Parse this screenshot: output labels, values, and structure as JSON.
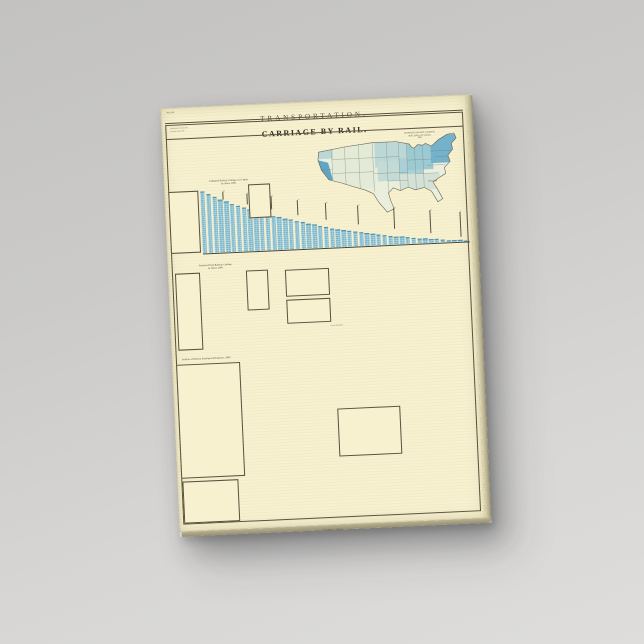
{
  "canvas": {
    "plate_no": "Plate 142.",
    "series_title": "TRANSPORTATION.",
    "title": "CARRIAGE BY RAIL.",
    "note_lines": [
      "Based upon the returns of the",
      "Eleventh Census, 1890."
    ],
    "imprint": "JULIUS BIEN & CO. LITH. N.Y."
  },
  "map": {
    "title_lines": [
      "ESTIMATED RAILWAY CARRIAGE,",
      "PER CAPITA, BY STATES,",
      "1890."
    ],
    "legend_title": "DOLLARS.",
    "legend": [
      {
        "label": "Under 5",
        "color": "#e9efdc"
      },
      {
        "label": "5 to 10",
        "color": "#d7e5d8"
      },
      {
        "label": "10 to 15",
        "color": "#bcd8d6"
      },
      {
        "label": "15 to 20",
        "color": "#9ccad3"
      },
      {
        "label": "20 to 30",
        "color": "#7cb8cd"
      },
      {
        "label": "30 to 40",
        "color": "#5ba4c4"
      },
      {
        "label": "40 to 50",
        "color": "#3f8fb6"
      },
      {
        "label": "50 and over",
        "color": "#2c7aa6"
      }
    ]
  },
  "chart_data": [
    {
      "id": "per_capita",
      "type": "bar",
      "orientation": "vertical",
      "title_lines": [
        "Estimated Railway Carriage, per Capita,",
        "by States, 1890."
      ],
      "table_head": [
        "STATES.",
        "DOLLS."
      ],
      "unit": "dollars per capita",
      "categories": [
        "Nevada",
        "Montana",
        "Wyoming",
        "Colorado",
        "Arizona",
        "New Hampshire",
        "Massachusetts",
        "Idaho",
        "Connecticut",
        "California",
        "New York",
        "Washington",
        "Oregon",
        "Illinois",
        "New Jersey",
        "Pennsylvania",
        "Utah",
        "Minnesota",
        "Rhode Island",
        "Maryland",
        "Ohio",
        "Vermont",
        "Maine",
        "Iowa",
        "Wisconsin",
        "Michigan",
        "Missouri",
        "Nebraska",
        "Kansas",
        "Delaware",
        "Indiana",
        "New Mexico",
        "Florida",
        "Texas",
        "Kentucky",
        "Virginia",
        "Georgia",
        "Louisiana",
        "Tennessee",
        "West Virginia",
        "South Carolina",
        "Alabama",
        "North Carolina",
        "Arkansas",
        "Mississippi",
        "Dakota"
      ],
      "values": [
        62,
        59,
        56,
        53.5,
        51,
        48.5,
        46,
        44,
        42,
        40,
        38,
        36,
        34.5,
        33,
        31.5,
        30,
        28.5,
        27,
        25.5,
        24,
        22.5,
        21,
        19.5,
        18,
        17,
        16,
        15,
        14,
        13,
        12,
        11,
        10,
        9.2,
        8.4,
        7.6,
        6.8,
        6.1,
        5.4,
        4.8,
        4.2,
        3.6,
        3,
        2.5,
        2,
        1.6,
        1.2
      ],
      "pins": [
        {
          "x": 22,
          "top": 0,
          "h": 8,
          "t": "50"
        },
        {
          "x": 46,
          "top": 3,
          "h": 11,
          "t": "45"
        },
        {
          "x": 70,
          "top": 7,
          "h": 13,
          "t": "40"
        },
        {
          "x": 96,
          "top": 12,
          "h": 15,
          "t": "34"
        },
        {
          "x": 124,
          "top": 16,
          "h": 17,
          "t": "28"
        },
        {
          "x": 156,
          "top": 20,
          "h": 19,
          "t": "22"
        },
        {
          "x": 192,
          "top": 24,
          "h": 21,
          "t": "16"
        },
        {
          "x": 228,
          "top": 28,
          "h": 23,
          "t": "10"
        },
        {
          "x": 258,
          "top": 31,
          "h": 25,
          "t": "5"
        }
      ]
    },
    {
      "id": "total_carriage",
      "type": "bar",
      "orientation": "horizontal",
      "title_lines": [
        "Estimated Total Railway Carriage,",
        "by States, 1890."
      ],
      "table_head": [
        "STATES.",
        "MILLIONS."
      ],
      "unit": "millions of dollars",
      "categories": [
        "New York",
        "Pennsylvania",
        "Illinois",
        "Ohio",
        "Massachusetts",
        "Missouri",
        "Iowa",
        "Indiana",
        "Michigan",
        "Kansas",
        "Texas",
        "Wisconsin",
        "Minnesota",
        "California",
        "New Jersey",
        "Kentucky",
        "Georgia",
        "Tennessee",
        "Virginia",
        "Nebraska",
        "Maryland",
        "Connecticut",
        "Alabama",
        "Colorado",
        "Maine",
        "North Carolina",
        "South Carolina",
        "Louisiana",
        "Mississippi",
        "Arkansas",
        "New Hampshire",
        "West Virginia",
        "Vermont",
        "Montana",
        "Rhode Island",
        "Florida",
        "Oregon",
        "Washington",
        "Delaware",
        "Utah",
        "Nevada",
        "Wyoming",
        "Idaho",
        "New Mexico",
        "Arizona"
      ],
      "values": [
        268,
        240,
        213,
        190,
        170,
        152,
        136,
        122,
        109,
        98,
        88,
        79,
        71,
        64,
        57,
        51,
        46,
        41,
        37,
        33,
        30,
        27,
        24,
        21.5,
        19,
        17,
        15,
        13.5,
        12,
        10.7,
        9.5,
        8.4,
        7.4,
        6.5,
        5.7,
        5,
        4.4,
        3.8,
        3.3,
        2.8,
        2.4,
        2,
        1.7,
        1.4,
        1.1
      ],
      "ticks": [
        "0",
        "50",
        "100",
        "150",
        "200",
        "250",
        "300",
        "350",
        "400",
        "450",
        "500"
      ],
      "callouts": [
        {
          "x": 270,
          "y": 0,
          "t": "New York"
        },
        {
          "x": 242,
          "y": 2,
          "t": "Pennsylvania"
        },
        {
          "x": 215,
          "y": 3,
          "t": "Illinois"
        },
        {
          "x": 192,
          "y": 5,
          "t": "Ohio"
        },
        {
          "x": 154,
          "y": 8,
          "t": "Missouri"
        },
        {
          "x": 111,
          "y": 13,
          "t": "Michigan"
        },
        {
          "x": 73,
          "y": 21,
          "t": "New Jersey"
        },
        {
          "x": 48,
          "y": 31,
          "t": "Maryland"
        },
        {
          "x": 31,
          "y": 44,
          "t": "Louisiana"
        },
        {
          "x": 20,
          "y": 60,
          "t": "Oregon"
        }
      ]
    },
    {
      "id": "earnings_expenses",
      "type": "bar",
      "orientation": "horizontal",
      "title": "Analysis of Railway Earnings and Expenses, 1890.",
      "table_head": [
        "ITEMS.",
        "AMOUNT."
      ],
      "unit": "millions of dollars",
      "categories": [
        "Gross earnings from operation",
        "Passenger revenue",
        "Freight revenue",
        "Mail and express",
        "Other earnings from operation",
        "Income from investments",
        "Total income",
        "Maintenance of way and structures",
        "Repairs of roadway",
        "Renewals of rails",
        "Renewals of ties",
        "Repairs of bridges",
        "Repairs of buildings",
        "Other expenses of way",
        "Maintenance of equipment",
        "Repairs of locomotives",
        "Repairs of passenger cars",
        "Repairs of freight cars",
        "Other equipment expenses",
        "Conducting transportation",
        "Engine and roundhouse men",
        "Fuel for locomotives",
        "Train service",
        "Station service",
        "Switchmen, flagmen, watchmen",
        "Telegraph service",
        "Loss and damage",
        "Injuries to persons",
        "Other transportation expenses",
        "General expenses",
        "Salaries of general officers",
        "Salaries of clerks",
        "General office expenses",
        "Law expenses",
        "Insurance",
        "Advertising",
        "Other general expenses",
        "Total operating expenses",
        "Net earnings from operation",
        "Taxes",
        "Interest on funded debt",
        "Dividends on stock",
        "Other deductions",
        "Surplus for the year"
      ],
      "values": [
        232,
        98,
        140,
        12,
        8,
        10,
        228,
        52,
        16,
        11,
        9,
        6,
        5,
        4,
        36,
        16,
        7,
        11,
        4,
        102,
        20,
        26,
        28,
        18,
        9,
        4,
        5,
        6,
        7,
        18,
        5,
        7,
        3,
        3,
        4,
        2,
        3,
        188,
        92,
        15,
        78,
        28,
        10,
        22
      ],
      "ticks": [
        "0",
        "25",
        "50",
        "75",
        "100",
        "125",
        "150",
        "175",
        "200"
      ],
      "callouts": [
        {
          "x": 236,
          "y": 0,
          "t": "Gross earnings"
        },
        {
          "x": 144,
          "y": 5,
          "t": "Freight revenue"
        },
        {
          "x": 102,
          "y": 2.6,
          "t": "Passenger revenue"
        },
        {
          "x": 106,
          "y": 49,
          "t": "Conducting transportation"
        },
        {
          "x": 192,
          "y": 96,
          "t": "Total operating expenses"
        },
        {
          "x": 96,
          "y": 100,
          "t": "Net earnings"
        },
        {
          "x": 82,
          "y": 104,
          "t": "Interest on funded debt"
        },
        {
          "x": 26,
          "y": 112,
          "t": "Surplus"
        }
      ]
    },
    {
      "id": "railway_debt",
      "type": "bar",
      "orientation": "horizontal",
      "title": "Railway Debt, 1890.",
      "table_head": [
        "ITEMS.",
        "AMOUNT."
      ],
      "unit": "millions of dollars",
      "categories": [
        "Mortgage bonds",
        "Miscellaneous obligations",
        "Income bonds",
        "Equipment trusts",
        "Collateral trust bonds",
        "Debentures",
        "Receivers' certificates",
        "Total funded debt",
        "Floating debt",
        "Interest accrued",
        "Current liabilities",
        "Total railway debt",
        "Interest in default",
        "Debt per mile"
      ],
      "values": [
        236,
        233,
        230,
        227,
        224,
        221,
        218,
        215,
        44,
        34,
        25,
        228,
        16,
        10
      ],
      "ticks": [
        "0",
        "100",
        "200",
        "300",
        "400",
        "500",
        "600",
        "700"
      ],
      "callouts": [
        {
          "x": 46,
          "y": 24,
          "t": "Floating debt"
        },
        {
          "x": 30,
          "y": 28,
          "t": "Current liabilities"
        },
        {
          "x": 12,
          "y": 32,
          "t": "Interest in default"
        }
      ]
    },
    {
      "id": "rolling_stock",
      "type": "table",
      "title": "Total Rolling Stock, 1890.",
      "rows": [
        [
          "Locomotives",
          "29,928"
        ],
        [
          "Passenger cars",
          "26,511"
        ],
        [
          "Baggage, mail and express cars",
          "7,561"
        ],
        [
          "Freight cars",
          "1,047,117"
        ],
        [
          "Company's service cars",
          "41,602"
        ],
        [
          "Total cars",
          "1,122,791"
        ]
      ],
      "bars": [
        139,
        58
      ],
      "ticks": [
        "1",
        "2",
        "3",
        "4",
        "5"
      ]
    },
    {
      "id": "profit_capital_stock",
      "type": "table",
      "title": "Profit on Capital Stock, 1890.",
      "rows": [
        [
          "Capital stock outstanding",
          "$4,409,658,485"
        ],
        [
          "Stock paying dividends",
          "1,506,341,903"
        ],
        [
          "Dividends declared",
          "87,626,894"
        ],
        [
          "Rate on dividend-paying stock",
          "5.82 p.c."
        ],
        [
          "Rate on total stock",
          "1.99 p.c."
        ]
      ],
      "bars": [
        139,
        118,
        92
      ],
      "ticks": [
        "1",
        "2",
        "3",
        "4",
        "5"
      ]
    },
    {
      "id": "gross_liabilities",
      "type": "table",
      "title": "Gross Liabilities, &c., per Mile, 1890.",
      "rows": [
        [
          "Capital stock",
          "$27,785"
        ],
        [
          "Funded debt",
          "27,074"
        ],
        [
          "Unfunded debt",
          "2,777"
        ],
        [
          "Current liabilities",
          "5,777"
        ],
        [
          "Gross liabilities",
          "63,413"
        ],
        [
          "Cost of road and equipment",
          "56,023"
        ],
        [
          "Excess of liabilities",
          "7,390"
        ],
        [
          "Per mile of line",
          "$63,413"
        ]
      ],
      "bars": [
        72,
        64,
        56,
        48,
        41,
        34,
        28,
        22,
        17,
        12,
        8,
        5
      ],
      "ticks": [
        "20",
        "40",
        "60"
      ],
      "callouts": [
        {
          "x": 6,
          "y": 38,
          "t": "Capital stock"
        },
        {
          "x": 24,
          "y": 42,
          "t": "Funded debt"
        },
        {
          "x": 44,
          "y": 46,
          "t": "Gross liabilities"
        }
      ]
    },
    {
      "id": "territories",
      "type": "table",
      "title": "Territories.",
      "rows": [
        [
          "Arizona",
          "9.61"
        ],
        [
          "Dakota",
          "21.40"
        ],
        [
          "Idaho",
          "18.75"
        ],
        [
          "Indian Ter.",
          "4.12"
        ],
        [
          "Montana",
          "33.08"
        ],
        [
          "New Mexico",
          "8.90"
        ],
        [
          "Oklahoma",
          "3.75"
        ],
        [
          "Utah",
          "12.66"
        ],
        [
          "Wyoming",
          "40.11"
        ],
        [
          "Alaska",
          "—"
        ],
        [
          "Dist. of Columbia",
          "6.05"
        ]
      ]
    },
    {
      "id": "cars_mini",
      "type": "bar",
      "label": "Cars per Locomotive.",
      "values": [
        22,
        9
      ]
    }
  ]
}
